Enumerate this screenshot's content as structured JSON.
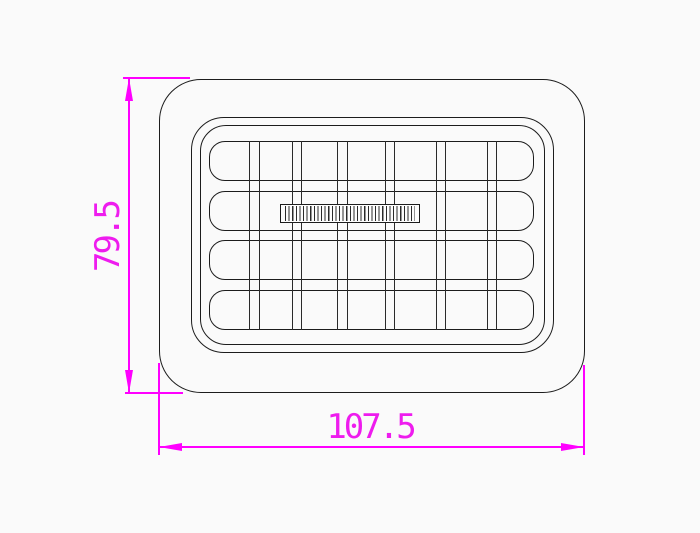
{
  "drawing": {
    "type": "CAD technical drawing, front view",
    "part_description": "rounded rectangular air vent grille with 4 horizontal slats, 6 vertical rib pairs and a knurled thumbwheel slider",
    "dimensions": {
      "height_label": "79.5",
      "width_label": "107.5"
    },
    "grille": {
      "slat_row_count": 4,
      "vertical_rib_pair_count": 6,
      "has_thumbwheel": true
    },
    "colors": {
      "dimension_annotation": "#ff00ff",
      "outline": "#1c1c1c",
      "background": "#fafafa"
    }
  }
}
